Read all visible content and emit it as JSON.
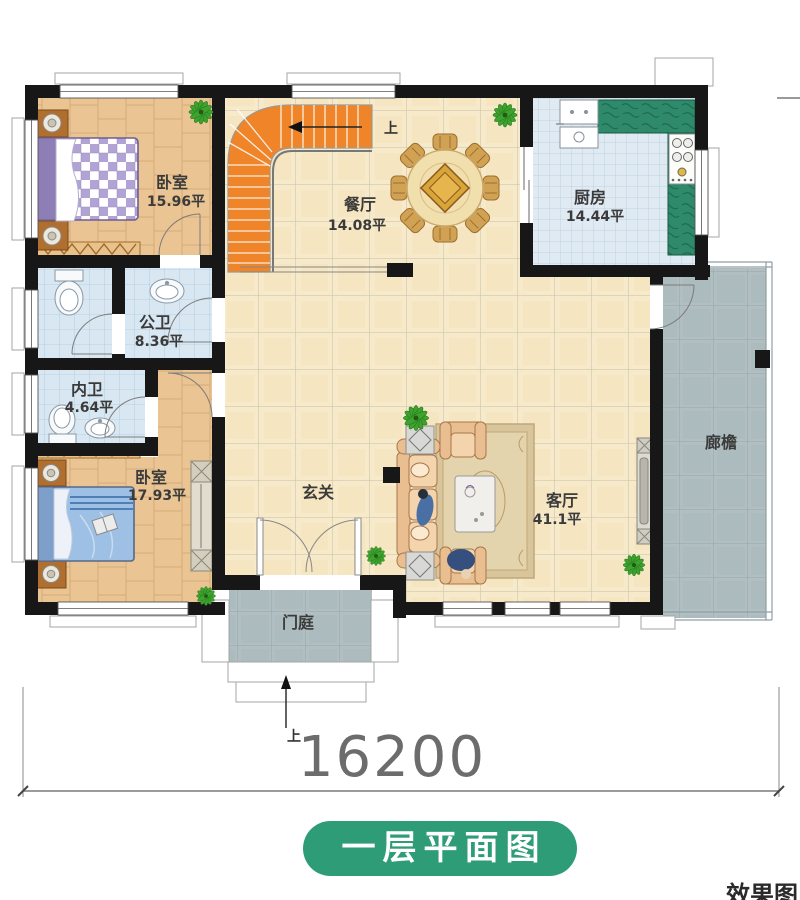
{
  "plan": {
    "title": "一层平面图",
    "corner_text": "效果图",
    "rooms": {
      "bedroom1": {
        "name": "卧室",
        "area": "15.96平"
      },
      "dining": {
        "name": "餐厅",
        "area": "14.08平"
      },
      "kitchen": {
        "name": "厨房",
        "area": "14.44平"
      },
      "public_bath": {
        "name": "公卫",
        "area": "8.36平"
      },
      "private_bath": {
        "name": "内卫",
        "area": "4.64平"
      },
      "bedroom2": {
        "name": "卧室",
        "area": "17.93平"
      },
      "foyer": {
        "name": "玄关"
      },
      "living": {
        "name": "客厅",
        "area": "41.1平"
      },
      "porch": {
        "name": "门庭"
      },
      "veranda": {
        "name": "廊檐"
      }
    },
    "stairs": {
      "up_label": "上"
    },
    "entry": {
      "up_label": "上"
    },
    "dimension": {
      "total_width": "16200"
    },
    "colors": {
      "wall": "#171717",
      "stair_orange": "#ef8428",
      "counter_green": "#2e8a6a",
      "title_badge_green": "#2d9c77",
      "wood_floor": "#ebc493",
      "cream_tile": "#f7eacb",
      "blue_tile": "#d8e7f1",
      "grey_tile": "#b2bfc2",
      "bed1_plaid": "#b1a3d4",
      "bed2_blue": "#9ec0e4"
    }
  }
}
